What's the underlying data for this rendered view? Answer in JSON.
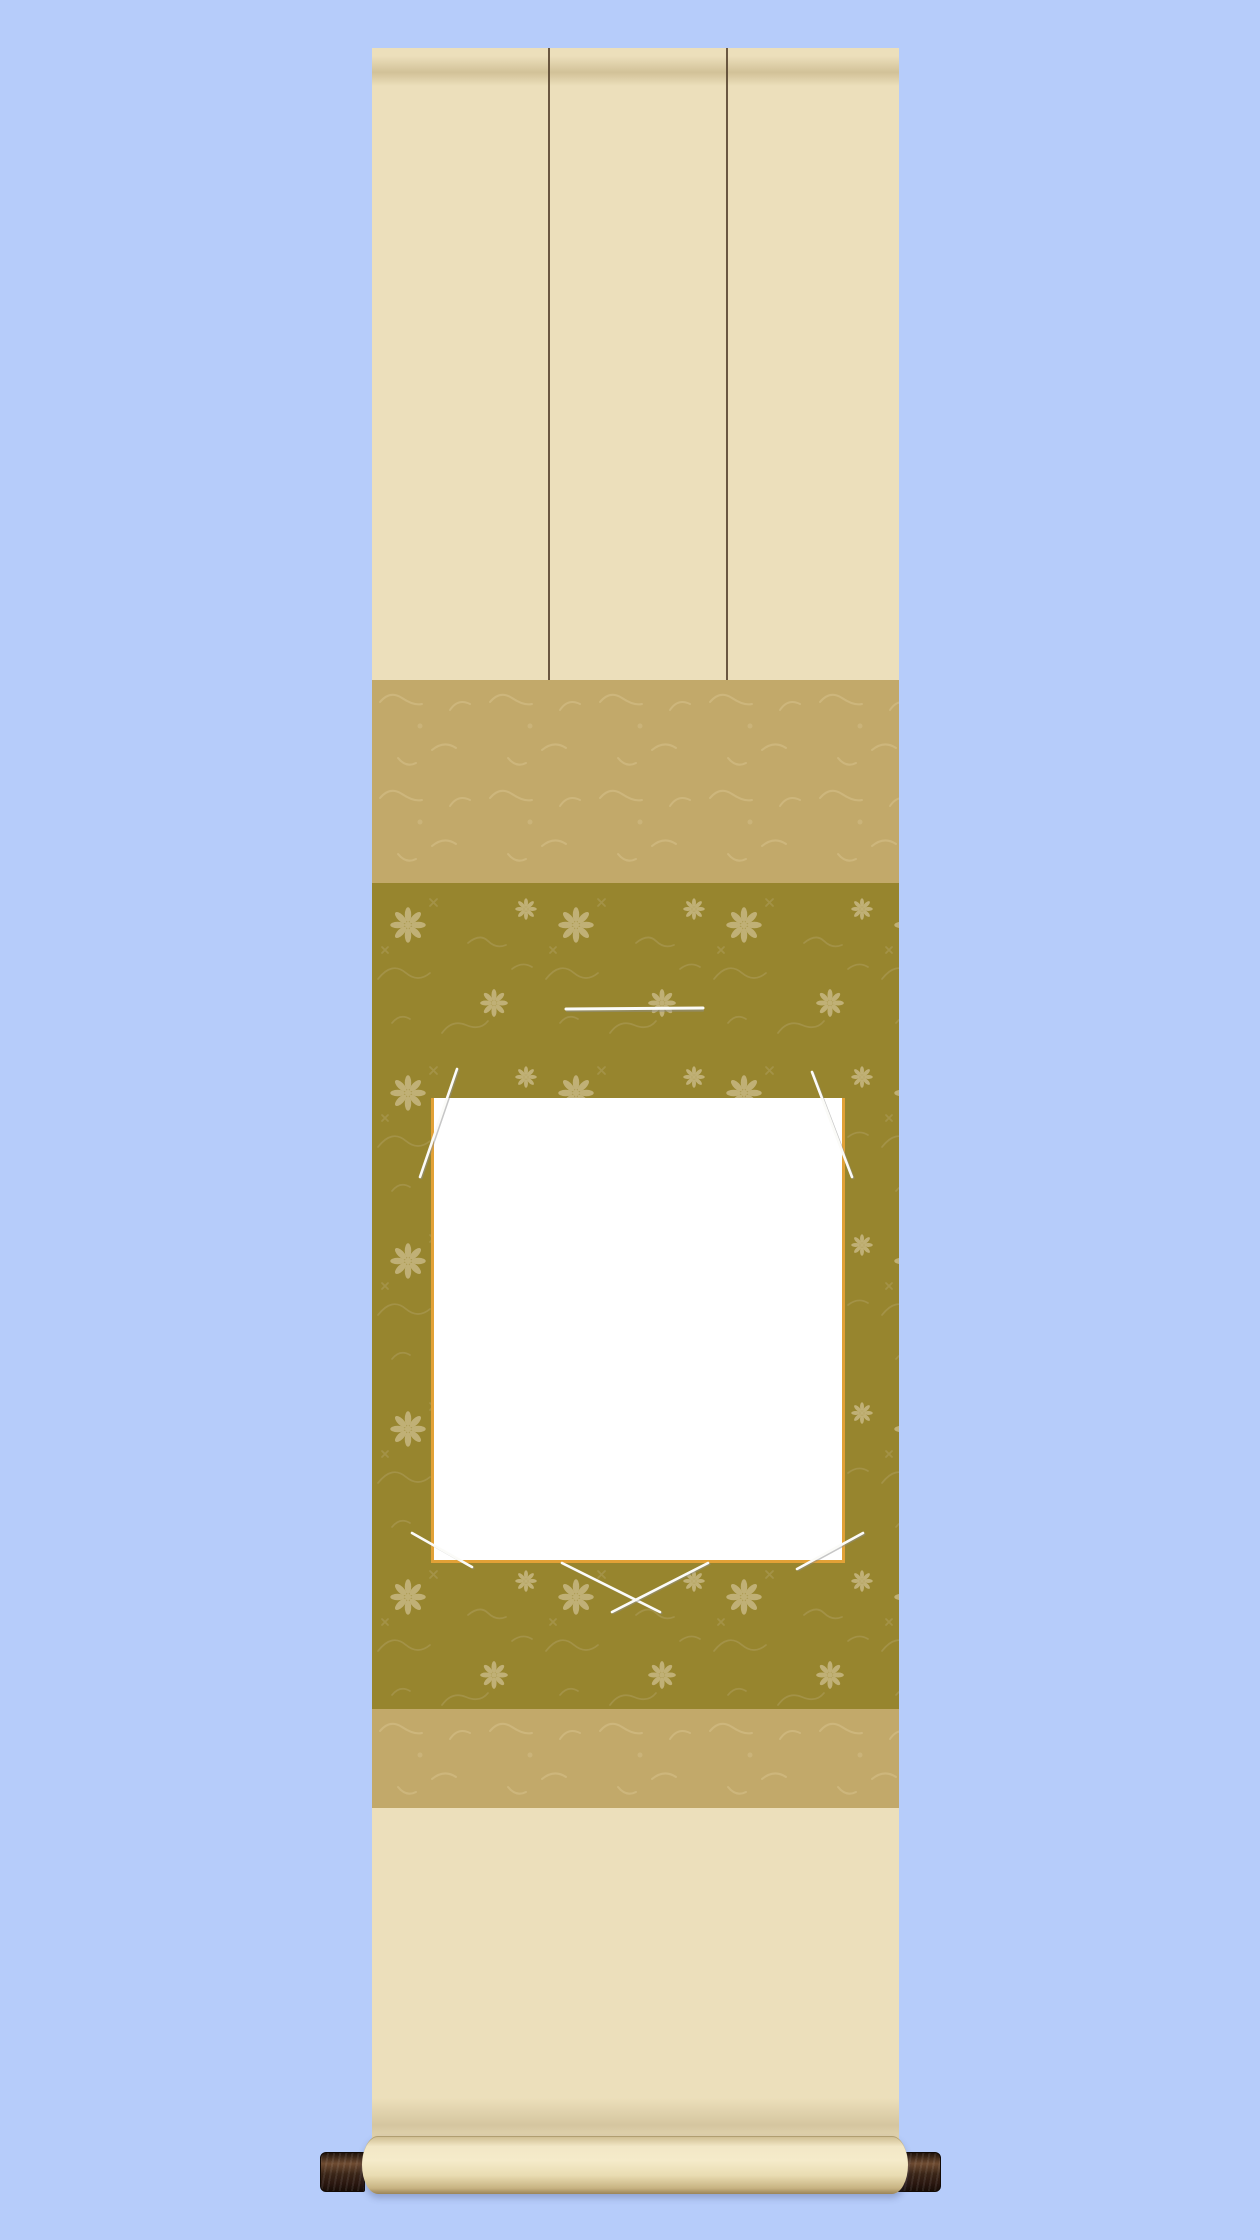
{
  "scene": {
    "description": "Product mockup photo of a Japanese hanging scroll (kakejiku) for a square shikishi art board, shown on a plain light-blue background",
    "visible_text": "none",
    "parts": {
      "top_section": "plain cream mounting cloth with two dark futai stripe lines",
      "upper_band": "tan brocade band with faint texture",
      "center_panel": "olive-gold floral damask panel",
      "hook_line": "small white horizontal retaining bar above the board",
      "shikishi_board": "blank white square board with gold rim",
      "retaining_cords": "thin white cords at the board corners, crossed below the board",
      "lower_band": "tan brocade band with faint texture",
      "bottom_section": "plain cream mounting cloth rolled at the bottom",
      "roller": "cream roller cylinder with dark brown wooden end knobs"
    }
  },
  "colors": {
    "page_background": "#b6ccfa",
    "fabric_cream": "#ecdfbb",
    "rod_shadow": "#8d753e",
    "band_tan": "#c2a96a",
    "band_tan_texture": "#d8c48e",
    "panel_olive": "#97852e",
    "panel_olive_motif": "#c4b47c",
    "panel_olive_vine": "#ac9b58",
    "shikishi_white": "#ffffff",
    "shikishi_trim_gold": "#e2a136",
    "cord_white": "#fbfbf8",
    "cord_shadow": "#8f8f8f",
    "futai_line": "#53402b",
    "edge_line": "#6e5c3f",
    "roller_knob": "#3a2517",
    "roller_knob_highlight": "#6e4b31",
    "roller_cream_light": "#f2e7c6",
    "roller_cream_dark": "#c7b382",
    "roller_edge": "#9b8456"
  }
}
